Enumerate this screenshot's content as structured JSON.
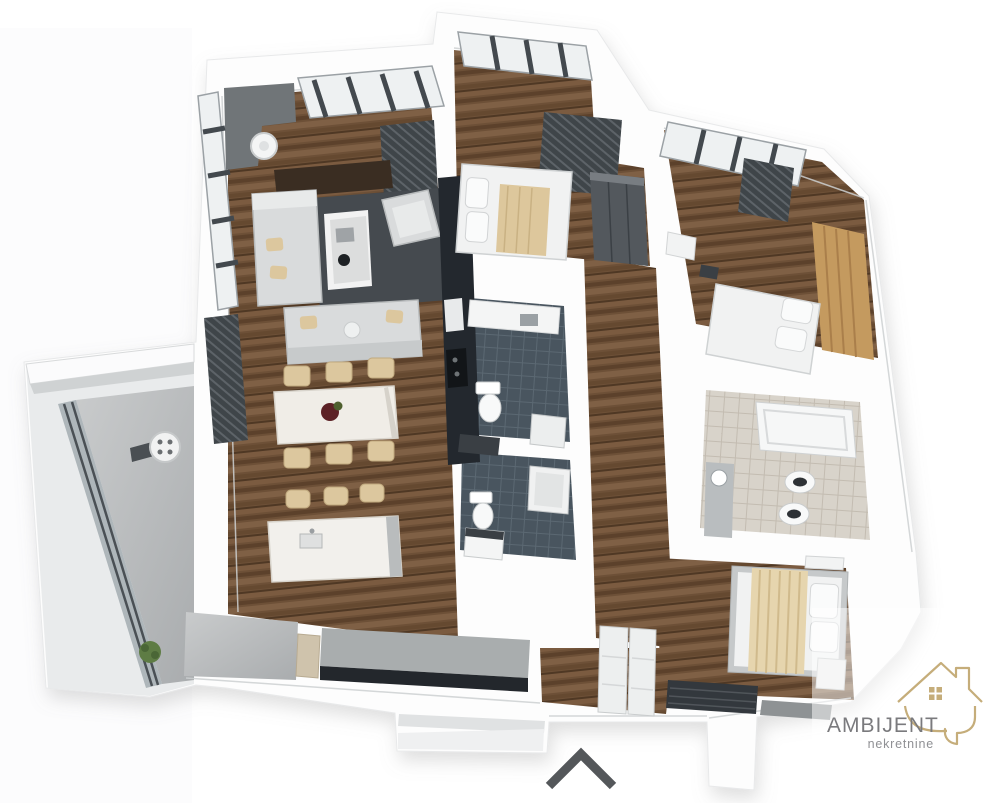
{
  "branding": {
    "name": "AMBIJENT",
    "tagline": "nekretnine",
    "name_color": "#7a7a7d",
    "tagline_color": "#8f9094",
    "icon": "house-outline-icon",
    "icon_color": "#c5ad7a"
  },
  "controls": {
    "scroll_up": {
      "icon": "chevron-up-icon",
      "color": "#54575a"
    }
  },
  "floor_plan": {
    "view": "3d-top-down-apartment-render",
    "rooms": [
      {
        "name": "living-dining-kitchen",
        "floor": "dark-wood",
        "furniture": [
          "corner-sofa",
          "lounge-sofa",
          "armchair",
          "coffee-table",
          "area-rug",
          "tv-panel",
          "dining-table",
          "six-chairs",
          "kitchen-cabinets",
          "kitchen-island",
          "bar-stools",
          "sideboard",
          "ceiling-lamp"
        ]
      },
      {
        "name": "bedroom-top",
        "floor": "dark-wood",
        "furniture": [
          "double-bed",
          "beige-blanket",
          "wardrobe",
          "radiator",
          "window"
        ]
      },
      {
        "name": "bedroom-right",
        "floor": "dark-wood",
        "furniture": [
          "double-bed",
          "wood-headboard-panel",
          "nightstand",
          "radiator",
          "window"
        ]
      },
      {
        "name": "bedroom-bottom-right",
        "floor": "dark-wood",
        "furniture": [
          "double-bed",
          "fringed-bedspread",
          "nightstand",
          "storage-bench",
          "rug",
          "closets"
        ]
      },
      {
        "name": "bathroom-upper",
        "floor": "dark-blue-tile",
        "fixtures": [
          "vanity-counter",
          "toilet",
          "shower-tray"
        ]
      },
      {
        "name": "bathroom-lower",
        "floor": "dark-blue-tile",
        "fixtures": [
          "shower",
          "toilet",
          "washing-machine"
        ]
      },
      {
        "name": "bathroom-right",
        "floor": "stone-tile",
        "fixtures": [
          "bathtub",
          "toilet",
          "bidet",
          "vanity"
        ]
      },
      {
        "name": "hallway",
        "floor": "dark-wood"
      },
      {
        "name": "entry",
        "floor": "concrete"
      },
      {
        "name": "balcony",
        "floor": "concrete",
        "furniture": [
          "grill-table",
          "plant"
        ],
        "features": [
          "glass-wall",
          "canopy"
        ]
      }
    ],
    "palette": {
      "wall": "#fdfdfd",
      "wall_shadow": "#cdd0d1",
      "wood_floor": "#6d5037",
      "tile_dark": "#49555f",
      "tile_light": "#d8d3ca",
      "concrete": "#bcbfc0",
      "furniture_gray": "#d9dbdc",
      "furniture_beige": "#dcc79e",
      "dark_fixture": "#3f4549",
      "glass": "#eef1f2",
      "flower_accent": "#5c2125",
      "plant_green": "#5e7c44"
    }
  }
}
